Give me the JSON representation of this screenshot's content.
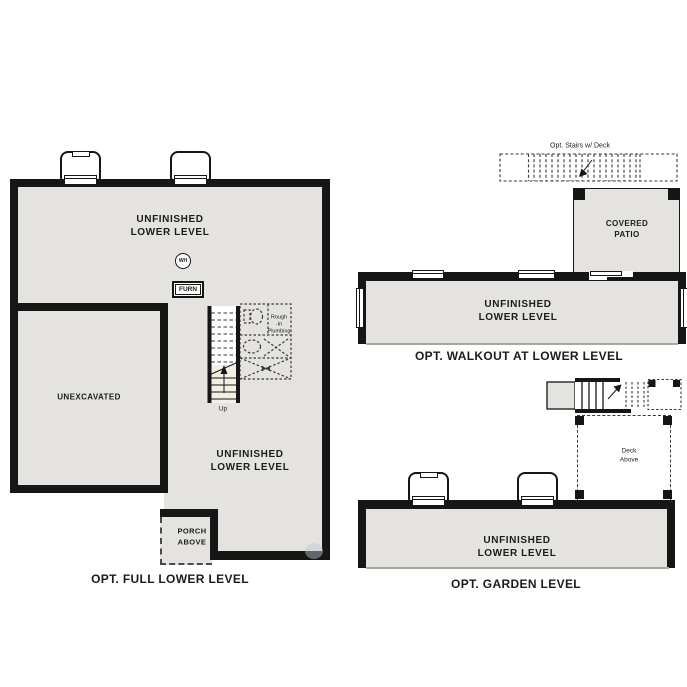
{
  "colors": {
    "floor": "#e4e3e0",
    "wall": "#161616",
    "dashed_line": "#3a3a3a",
    "stair_fill": "#f2efe4",
    "cut_line": "#a9a7a3"
  },
  "plans": {
    "full_lower": {
      "caption": "OPT. FULL LOWER LEVEL",
      "labels": {
        "upper_room": "UNFINISHED\nLOWER LEVEL",
        "unexcavated": "UNEXCAVATED",
        "lower_room": "UNFINISHED\nLOWER LEVEL",
        "porch": "PORCH\nABOVE",
        "water_heater": "WH",
        "furnace": "FURN",
        "stairs_up": "Up",
        "rough_in": "Rough\n-In\nPlumbing"
      }
    },
    "walkout": {
      "caption": "OPT. WALKOUT AT LOWER LEVEL",
      "labels": {
        "opt_stairs": "Opt. Stairs w/ Deck",
        "covered_patio": "COVERED\nPATIO",
        "room": "UNFINISHED\nLOWER LEVEL"
      }
    },
    "garden": {
      "caption": "OPT. GARDEN LEVEL",
      "labels": {
        "deck_above": "Deck\nAbove",
        "room": "UNFINISHED\nLOWER LEVEL"
      }
    }
  }
}
